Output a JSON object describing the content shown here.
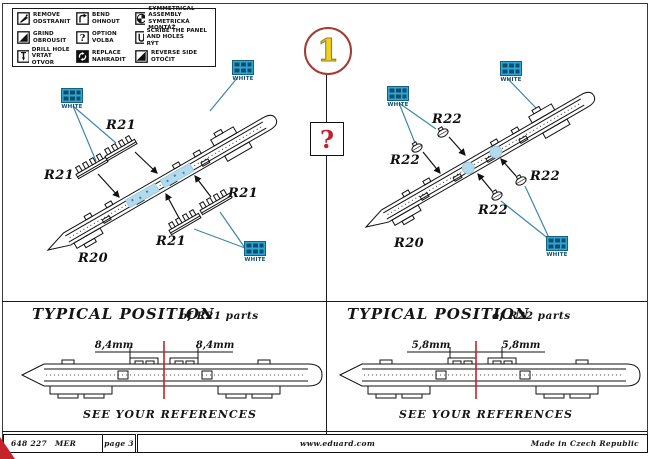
{
  "page": {
    "step_number": "1",
    "option_mark": "?"
  },
  "legend": {
    "items": [
      {
        "en": "REMOVE",
        "cz": "ODSTRANIT"
      },
      {
        "en": "BEND",
        "cz": "OHNOUT"
      },
      {
        "en": "SYMMETRICAL ASSEMBLY",
        "cz": "SYMETRICKÁ MONTÁŽ"
      },
      {
        "en": "GRIND",
        "cz": "OBROUSIT"
      },
      {
        "en": "OPTION",
        "cz": "VOLBA"
      },
      {
        "en": "SCRIBE THE PANEL AND HOLES",
        "cz": "RÝT"
      },
      {
        "en": "DRILL HOLE",
        "cz": "VRTAT OTVOR"
      },
      {
        "en": "REPLACE",
        "cz": "NAHRADIT"
      },
      {
        "en": "REVERSE SIDE",
        "cz": "OTOČIT"
      }
    ]
  },
  "diagram_left": {
    "part_labels": [
      "R21",
      "R21",
      "R21",
      "R21"
    ],
    "body_label": "R20",
    "color_note": "WHITE"
  },
  "diagram_right": {
    "part_labels": [
      "R22",
      "R22",
      "R22",
      "R22"
    ],
    "body_label": "R20",
    "color_note": "WHITE"
  },
  "typical_left": {
    "title": "TYPICAL POSITION",
    "subtitle": "of R21 parts",
    "dim_left": "8,4mm",
    "dim_right": "8,4mm",
    "note": "SEE YOUR REFERENCES"
  },
  "typical_right": {
    "title": "TYPICAL POSITION",
    "subtitle": "of R22 parts",
    "dim_left": "5,8mm",
    "dim_right": "5,8mm",
    "note": "SEE YOUR REFERENCES"
  },
  "footer": {
    "catalog_number": "648 227",
    "product": "MER",
    "page": "page 3",
    "website": "www.eduard.com",
    "made_in": "Made in Czech Republic"
  },
  "colors": {
    "pe_blue": "#2ea7d8",
    "leader_blue": "#3d87a8",
    "highlight_blue": "#b4daee",
    "accent_red": "#c4232b",
    "step_yellow": "#f2d11c"
  }
}
